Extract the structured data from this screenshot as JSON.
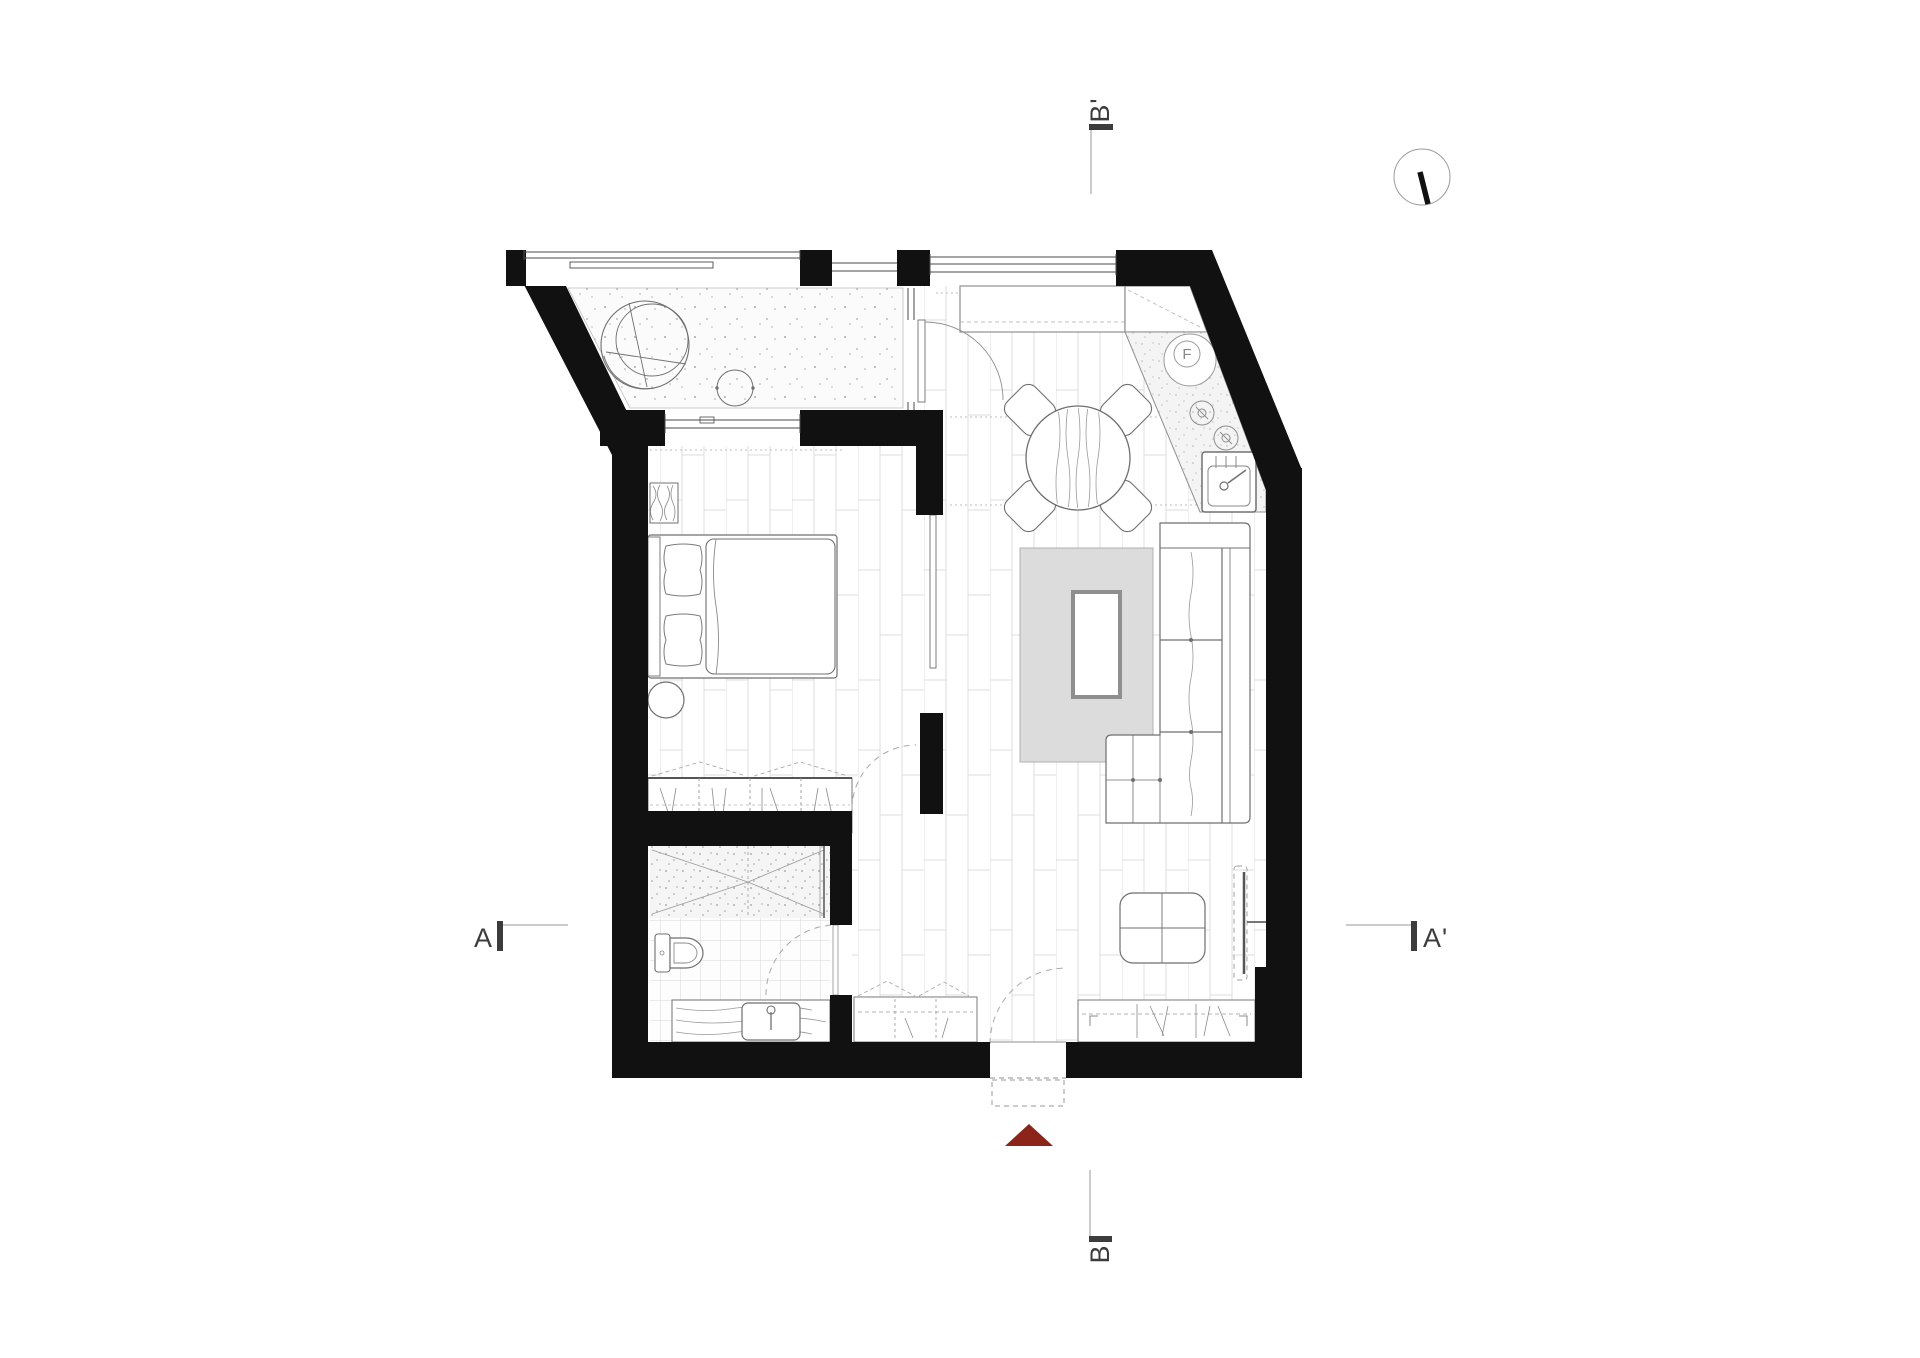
{
  "drawing": {
    "type": "architectural-floor-plan",
    "section_markers": {
      "a": "A",
      "a_prime": "A'",
      "b": "B",
      "b_prime": "B'"
    },
    "labels": {
      "fridge": "F"
    },
    "colors": {
      "wall": "#111111",
      "entrance_marker": "#8c241a",
      "rug": "#dcdcdc",
      "paper": "#ffffff"
    },
    "rooms": [
      "balcony",
      "bedroom",
      "living-room",
      "kitchen",
      "hallway",
      "bathroom"
    ]
  }
}
